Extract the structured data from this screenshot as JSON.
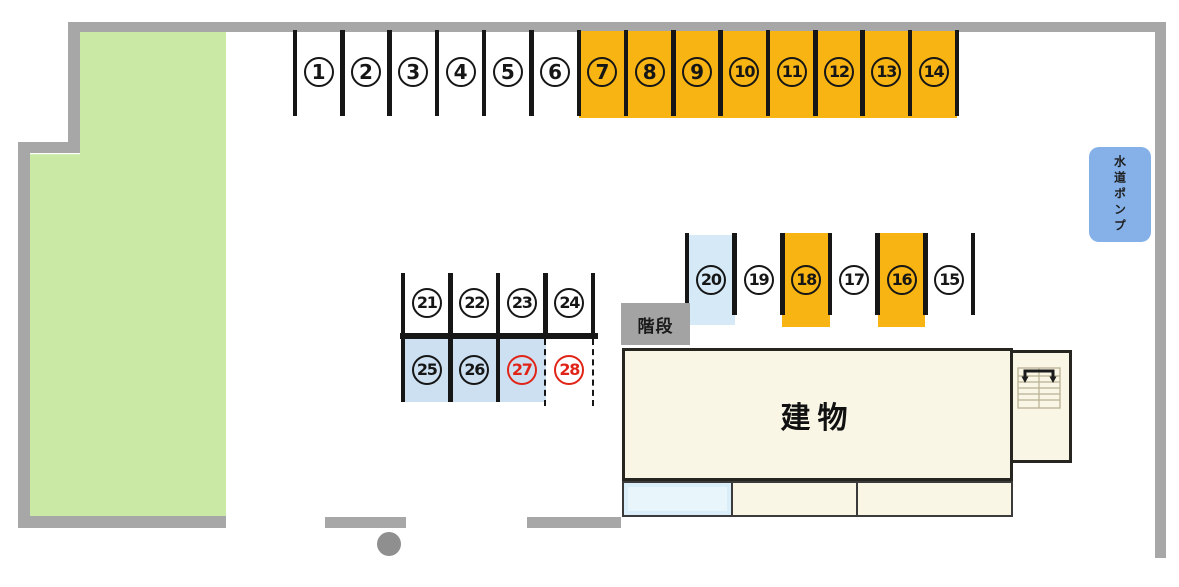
{
  "colors": {
    "orange": "#F8B412",
    "stall_blue": "#D5E9F6",
    "stall_blue_dark": "#CCE0F1",
    "pump_blue": "#85B1E8",
    "grass_green": "#C9E9A4",
    "wall_gray": "#A7A7A7",
    "stairs_gray": "#A3A3A3",
    "building_cream": "#F9F6E6",
    "porch_blue": "#D9EEF8",
    "porch_blue_inner": "#E8F5FB",
    "line_black": "#161616",
    "number_red": "#E02518"
  },
  "top_row": {
    "stalls": [
      {
        "n": "1",
        "c": "white"
      },
      {
        "n": "2",
        "c": "white"
      },
      {
        "n": "3",
        "c": "white"
      },
      {
        "n": "4",
        "c": "white"
      },
      {
        "n": "5",
        "c": "white"
      },
      {
        "n": "6",
        "c": "white"
      },
      {
        "n": "7",
        "c": "orange"
      },
      {
        "n": "8",
        "c": "orange"
      },
      {
        "n": "9",
        "c": "orange"
      },
      {
        "n": "10",
        "c": "orange"
      },
      {
        "n": "11",
        "c": "orange"
      },
      {
        "n": "12",
        "c": "orange"
      },
      {
        "n": "13",
        "c": "orange"
      },
      {
        "n": "14",
        "c": "orange"
      }
    ]
  },
  "mid_row": {
    "stalls": [
      {
        "n": "20",
        "c": "blue"
      },
      {
        "n": "19",
        "c": "white"
      },
      {
        "n": "18",
        "c": "orange"
      },
      {
        "n": "17",
        "c": "white"
      },
      {
        "n": "16",
        "c": "orange"
      },
      {
        "n": "15",
        "c": "white"
      }
    ]
  },
  "left_block": {
    "upper": [
      {
        "n": "21",
        "c": "white"
      },
      {
        "n": "22",
        "c": "white"
      },
      {
        "n": "23",
        "c": "white"
      },
      {
        "n": "24",
        "c": "white"
      }
    ],
    "lower": [
      {
        "n": "25",
        "c": "blue",
        "num_color": "black",
        "border": "solid"
      },
      {
        "n": "26",
        "c": "blue",
        "num_color": "black",
        "border": "solid"
      },
      {
        "n": "27",
        "c": "blue",
        "num_color": "red",
        "border": "solid"
      },
      {
        "n": "28",
        "c": "white",
        "num_color": "red",
        "border": "dashed"
      }
    ]
  },
  "labels": {
    "building": "建物",
    "stairs": "階段",
    "water_pump": "水道ポンプ"
  }
}
